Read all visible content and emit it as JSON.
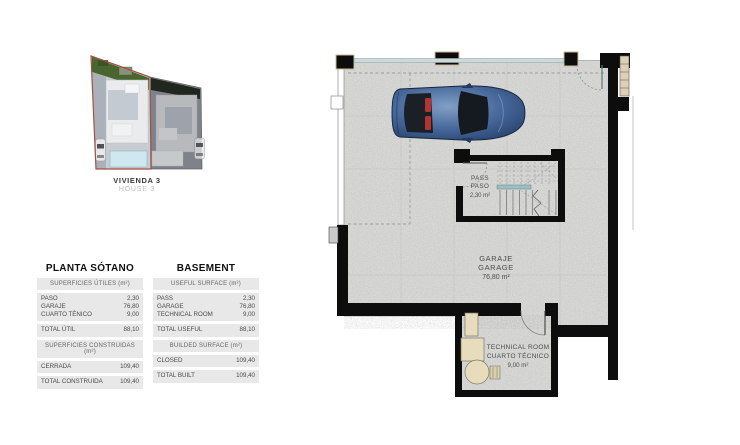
{
  "site": {
    "name_es": "VIVIENDA 3",
    "name_en": "HOUSE 3"
  },
  "tables": {
    "es": {
      "title": "PLANTA SÓTANO",
      "useful_header": "SUPERFICIES ÚTILES (m²)",
      "rows": [
        {
          "label": "PASO",
          "value": "2,30"
        },
        {
          "label": "GARAJE",
          "value": "76,80"
        },
        {
          "label": "CUARTO TÉNICO",
          "value": "9,00"
        }
      ],
      "total_useful": {
        "label": "TOTAL ÚTIL",
        "value": "88,10"
      },
      "built_header": "SUPERFICIES CONSTRUIDAS (m²)",
      "closed": {
        "label": "CERRADA",
        "value": "109,40"
      },
      "total_built": {
        "label": "TOTAL CONSTRUIDA",
        "value": "109,40"
      }
    },
    "en": {
      "title": "BASEMENT",
      "useful_header": "USEFUL SURFACE (m²)",
      "rows": [
        {
          "label": "PASS",
          "value": "2,30"
        },
        {
          "label": "GARAGE",
          "value": "76,80"
        },
        {
          "label": "TECHNICAL ROOM",
          "value": "9,00"
        }
      ],
      "total_useful": {
        "label": "TOTAL USEFUL",
        "value": "88,10"
      },
      "built_header": "BUILDED SURFACE (m²)",
      "closed": {
        "label": "CLOSED",
        "value": "109,40"
      },
      "total_built": {
        "label": "TOTAL BUILT",
        "value": "109,40"
      }
    }
  },
  "plan": {
    "pass": {
      "l1": "PASS",
      "l2": "PASO",
      "area": "2,30 m²"
    },
    "garage": {
      "l1": "GARAJE",
      "l2": "GARAGE",
      "area": "76,80 m²"
    },
    "tech": {
      "l1": "TECHNICAL ROOM",
      "l2": "CUARTO TÉCNICO",
      "area": "9,00 m²"
    }
  },
  "colors": {
    "wall": "#0d0d0d",
    "floor": "#d9d9d7",
    "glazing": "#cdd9da",
    "handrail_teal": "#9fbec0",
    "plot_outline_red": "#a05240",
    "car_blue": "#3c5c8c",
    "equipment_beige": "#e7ddbd",
    "table_band_gray": "#e8e8e8"
  }
}
